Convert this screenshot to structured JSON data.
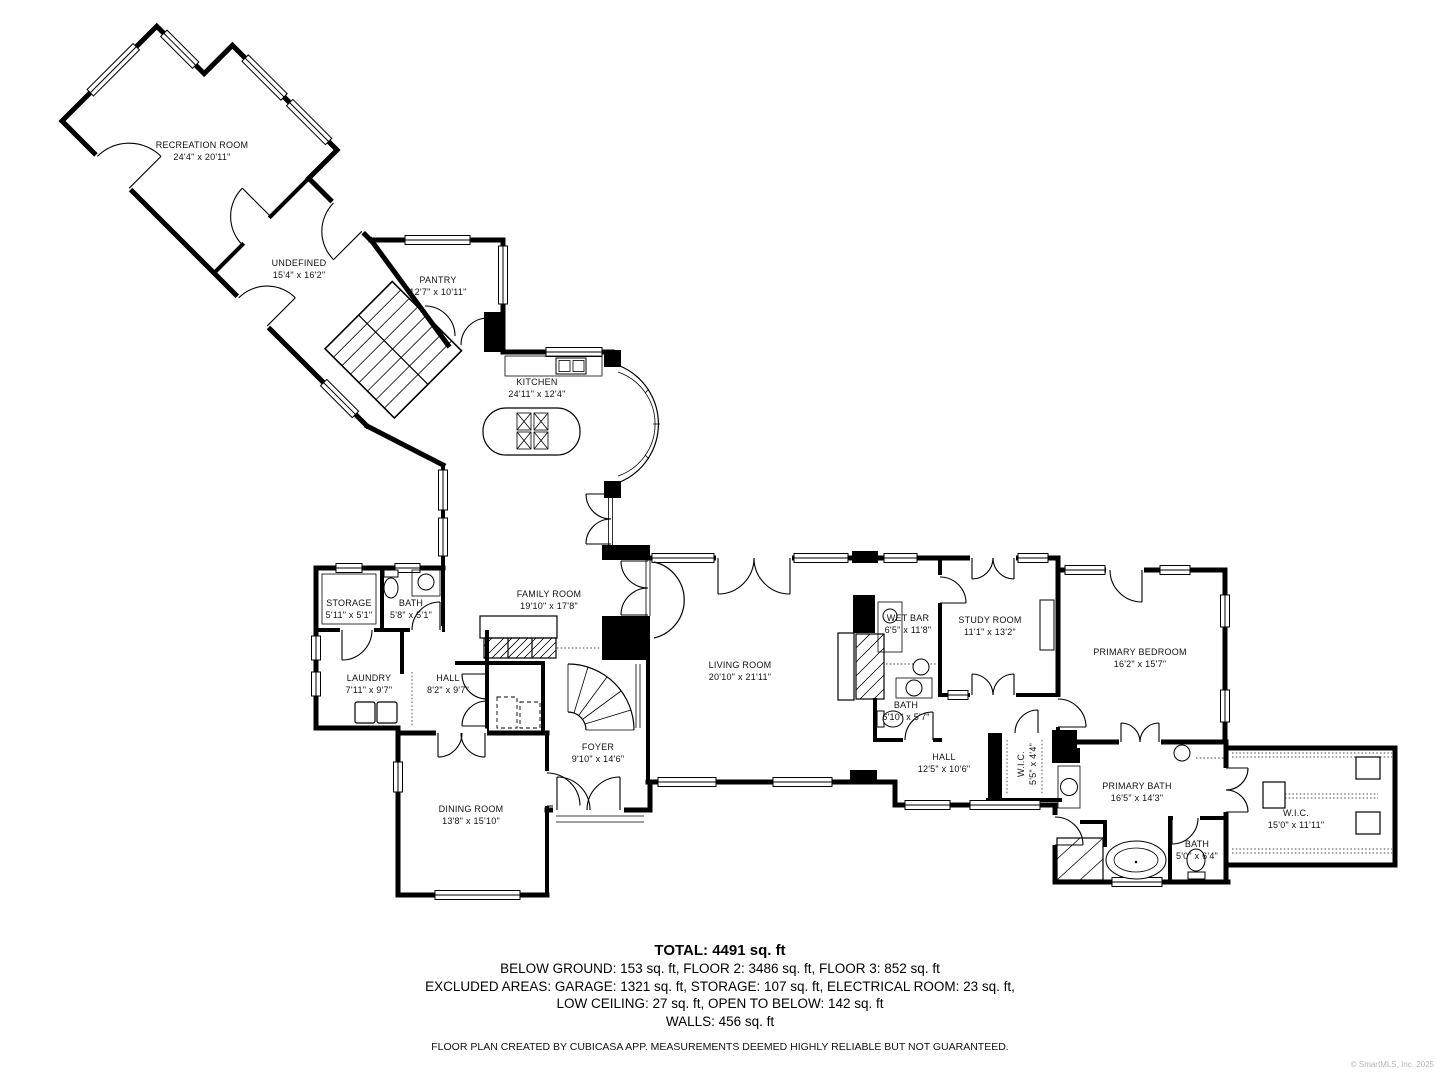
{
  "rooms": [
    {
      "id": "recreation-room",
      "name": "RECREATION ROOM",
      "dims": "24'4\" x 20'11\""
    },
    {
      "id": "undefined-room",
      "name": "UNDEFINED",
      "dims": "15'4\" x 16'2\""
    },
    {
      "id": "pantry",
      "name": "PANTRY",
      "dims": "12'7\" x 10'11\""
    },
    {
      "id": "kitchen",
      "name": "KITCHEN",
      "dims": "24'11\" x 12'4\""
    },
    {
      "id": "storage",
      "name": "STORAGE",
      "dims": "5'11\" x 5'1\""
    },
    {
      "id": "bath-1",
      "name": "BATH",
      "dims": "5'8\" x 5'1\""
    },
    {
      "id": "family-room",
      "name": "FAMILY ROOM",
      "dims": "19'10\" x 17'8\""
    },
    {
      "id": "laundry",
      "name": "LAUNDRY",
      "dims": "7'11\" x 9'7\""
    },
    {
      "id": "hall-1",
      "name": "HALL",
      "dims": "8'2\" x 9'7\""
    },
    {
      "id": "foyer",
      "name": "FOYER",
      "dims": "9'10\" x 14'6\""
    },
    {
      "id": "dining-room",
      "name": "DINING ROOM",
      "dims": "13'8\" x 15'10\""
    },
    {
      "id": "living-room",
      "name": "LIVING ROOM",
      "dims": "20'10\" x 21'11\""
    },
    {
      "id": "wet-bar",
      "name": "WET BAR",
      "dims": "6'5\" x 11'8\""
    },
    {
      "id": "bath-2",
      "name": "BATH",
      "dims": "6'10\" x 5'7\""
    },
    {
      "id": "study-room",
      "name": "STUDY ROOM",
      "dims": "11'1\" x 13'2\""
    },
    {
      "id": "hall-2",
      "name": "HALL",
      "dims": "12'5\" x 10'6\""
    },
    {
      "id": "wic-small",
      "name": "W.I.C.",
      "dims": "5'5\" x 4'4\""
    },
    {
      "id": "primary-bedroom",
      "name": "PRIMARY BEDROOM",
      "dims": "16'2\" x 15'7\""
    },
    {
      "id": "primary-bath",
      "name": "PRIMARY BATH",
      "dims": "16'5\" x 14'3\""
    },
    {
      "id": "bath-3",
      "name": "BATH",
      "dims": "5'0\" x 6'4\""
    },
    {
      "id": "wic-large",
      "name": "W.I.C.",
      "dims": "15'0\" x 11'11\""
    }
  ],
  "summary": {
    "total": "TOTAL: 4491 sq. ft",
    "line1": "BELOW GROUND: 153 sq. ft, FLOOR 2: 3486 sq. ft, FLOOR 3: 852 sq. ft",
    "line2": "EXCLUDED AREAS: GARAGE: 1321 sq. ft, STORAGE: 107 sq. ft, ELECTRICAL ROOM: 23 sq. ft,",
    "line3": "LOW CEILING: 27 sq. ft, OPEN TO BELOW: 142 sq. ft",
    "line4": "WALLS: 456 sq. ft"
  },
  "disclaimer": "FLOOR PLAN CREATED BY CUBICASA APP. MEASUREMENTS DEEMED HIGHLY RELIABLE BUT NOT GUARANTEED.",
  "copyright": "© SmartMLS, Inc.  2025",
  "colors": {
    "wall": "#000000",
    "background": "#ffffff",
    "label": "#111111",
    "copyright": "#b5b5b5"
  }
}
